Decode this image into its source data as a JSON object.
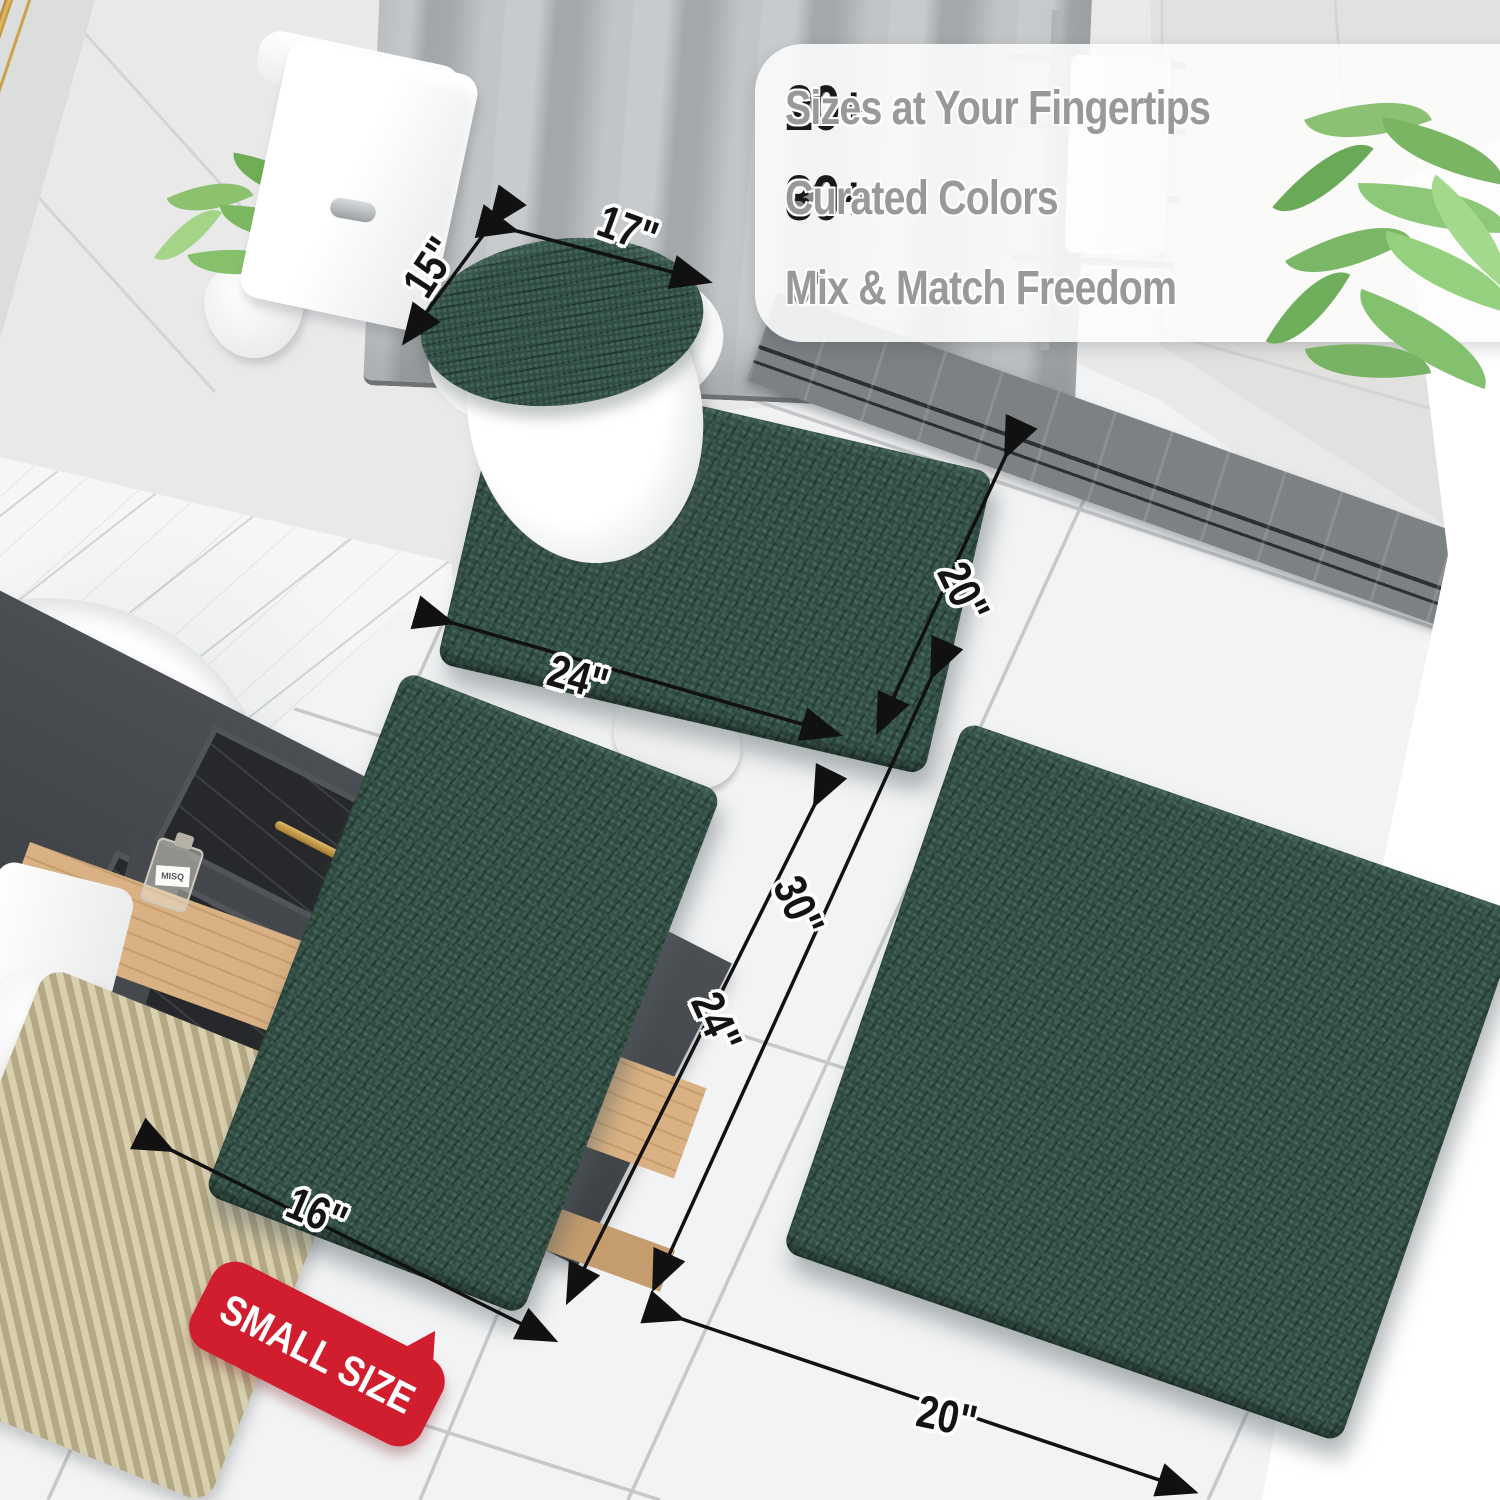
{
  "scene": {
    "description": "Bathroom product photo of a 3-piece dark green chenille bath rug set with size annotations",
    "colors": {
      "rug_green": "#2f4c42",
      "badge_red": "#d11e2e",
      "check_gray": "#85878a",
      "number_black": "#191919",
      "phrase_gray": "#97999b",
      "gold_accent": "#c9a050",
      "floor_white": "#f2f3f4"
    }
  },
  "features": {
    "rows": [
      {
        "icon": "checkmark-icon",
        "number": "20+",
        "text": "Sizes at Your Fingertips"
      },
      {
        "icon": "checkmark-icon",
        "number": "30+",
        "text": "Curated Colors"
      },
      {
        "icon": "checkmark-icon",
        "number": "",
        "text": "Mix & Match Freedom"
      }
    ]
  },
  "dimensions": [
    {
      "id": "lid-cover-width",
      "text": "15\""
    },
    {
      "id": "lid-cover-length",
      "text": "17\""
    },
    {
      "id": "contour-mat-length",
      "text": "24\""
    },
    {
      "id": "contour-mat-width",
      "text": "20\""
    },
    {
      "id": "large-rug-length",
      "text": "30\""
    },
    {
      "id": "small-rug-length",
      "text": "24\""
    },
    {
      "id": "small-rug-width",
      "text": "16\""
    },
    {
      "id": "large-rug-width",
      "text": "20\""
    }
  ],
  "badge": {
    "text": "SMALL SIZE"
  },
  "decor": {
    "bottle_label": "MISQ"
  }
}
